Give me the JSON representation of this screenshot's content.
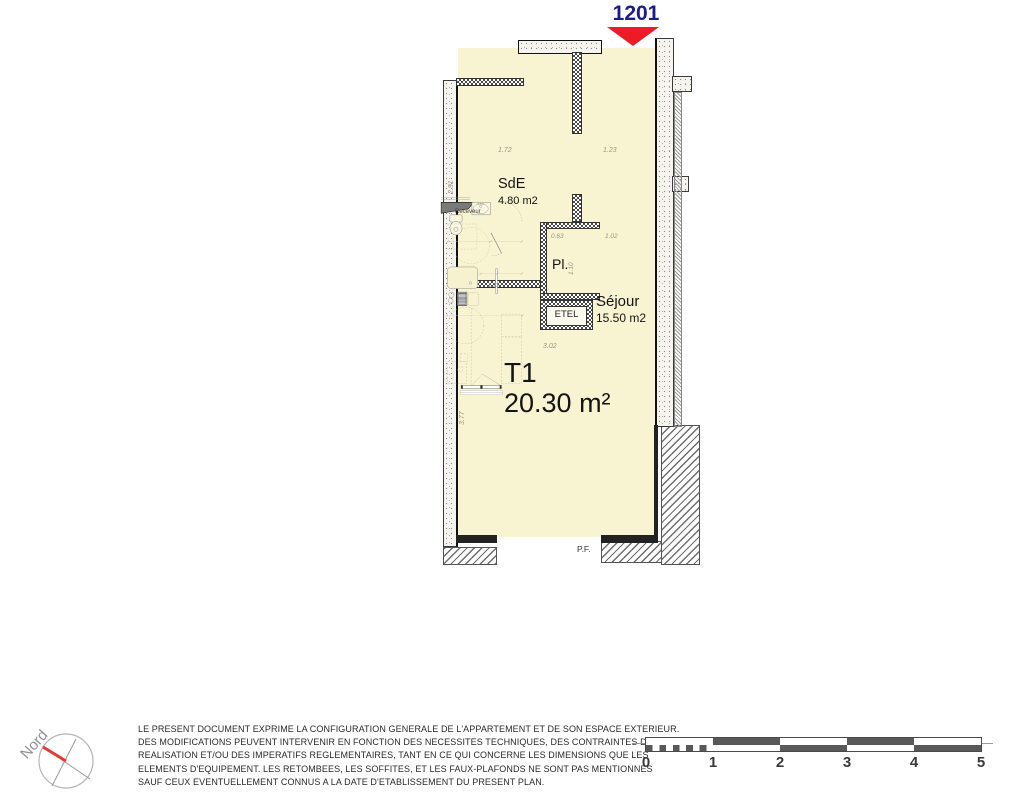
{
  "unit": {
    "number": "1201"
  },
  "apartment": {
    "type_label": "T1",
    "area_label": "20.30 m²"
  },
  "rooms": {
    "sde": {
      "name": "SdE",
      "area": "4.80 m2"
    },
    "pl": {
      "name": "Pl."
    },
    "sejour": {
      "name": "Séjour",
      "area": "15.50 m2"
    }
  },
  "fixtures": {
    "shower_tray": "Receveur",
    "etel": "ETEL",
    "window": "P.F."
  },
  "dims": {
    "bath_width": "1.72",
    "entry_width": "1.23",
    "bath_depth": "2.91",
    "closet_width": "0.63",
    "closet_side": "1.02",
    "closet_depth": "1.10",
    "kitchen_width": "1.23",
    "sejour_width": "3.02",
    "sejour_depth": "3.77"
  },
  "compass": {
    "label": "Nord"
  },
  "disclaimer": {
    "lines": [
      "LE PRESENT DOCUMENT EXPRIME LA CONFIGURATION GENERALE DE L'APPARTEMENT ET DE SON ESPACE EXTERIEUR.",
      "DES MODIFICATIONS PEUVENT INTERVENIR EN FONCTION DES NECESSITES TECHNIQUES, DES CONTRAINTES DE",
      "REALISATION ET/OU DES IMPERATIFS REGLEMENTAIRES, TANT EN CE QUI CONCERNE LES DIMENSIONS QUE LES",
      "ELEMENTS D'EQUIPEMENT. LES RETOMBEES, LES SOFFITES, ET LES FAUX-PLAFONDS NE SONT PAS MENTIONNES",
      "SAUF CEUX EVENTUELLEMENT CONNUS A LA DATE D'ETABLISSEMENT DU PRESENT PLAN."
    ]
  },
  "scale_bar": {
    "ticks": [
      "0",
      "1",
      "2",
      "3",
      "4",
      "5"
    ]
  },
  "colors": {
    "floor_fill": "#F8F4D1",
    "unit_number": "#1B1B8C",
    "arrow_red": "#ED1C24",
    "compass_red": "#E53935",
    "wall_dark": "#1A1A1A",
    "dim_text": "#9B9480",
    "scale_dark": "#595959",
    "body_text": "#2A2A2A"
  }
}
